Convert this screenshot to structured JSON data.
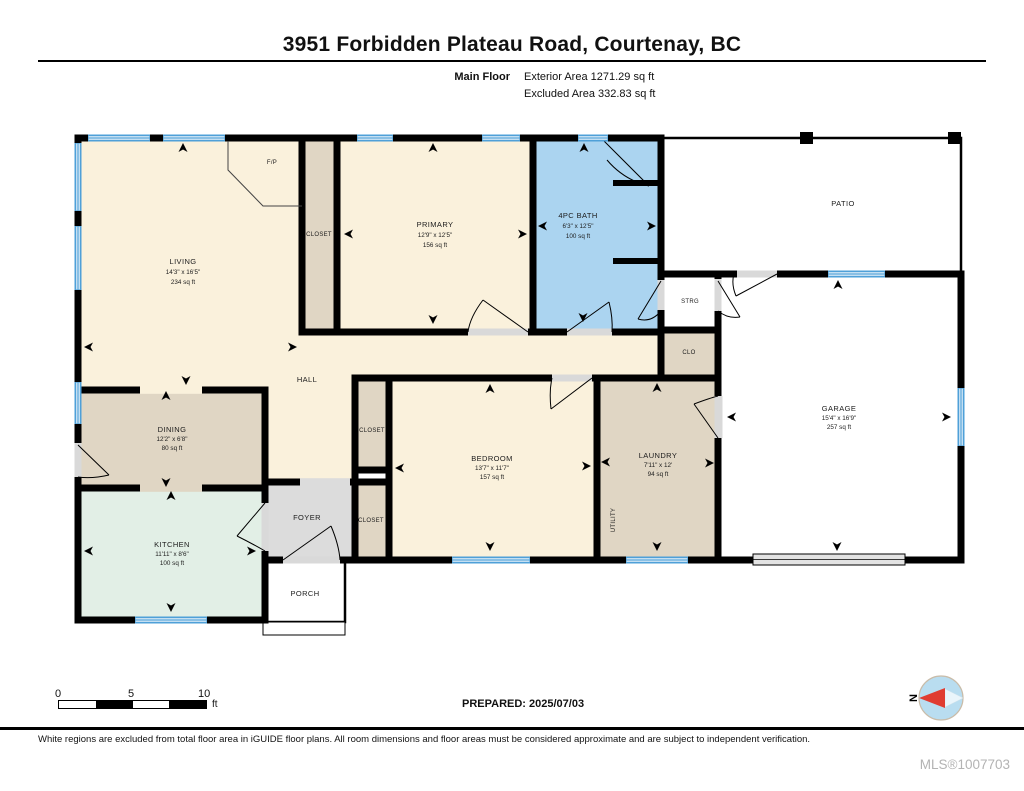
{
  "header": {
    "title": "3951 Forbidden Plateau Road, Courtenay, BC",
    "floor_label": "Main Floor",
    "exterior_area": "Exterior Area 1271.29 sq ft",
    "excluded_area": "Excluded Area 332.83 sq ft"
  },
  "rooms": {
    "living": {
      "name": "LIVING",
      "dims": "14'3\" x 16'5\"",
      "area": "234 sq ft"
    },
    "primary": {
      "name": "PRIMARY",
      "dims": "12'9\" x 12'5\"",
      "area": "156 sq ft"
    },
    "bath": {
      "name": "4PC BATH",
      "dims": "6'3\" x 12'5\"",
      "area": "100 sq ft"
    },
    "dining": {
      "name": "DINING",
      "dims": "12'2\" x 6'8\"",
      "area": "80 sq ft"
    },
    "kitchen": {
      "name": "KITCHEN",
      "dims": "11'11\" x 8'6\"",
      "area": "100 sq ft"
    },
    "bedroom": {
      "name": "BEDROOM",
      "dims": "13'7\" x 11'7\"",
      "area": "157 sq ft"
    },
    "laundry": {
      "name": "LAUNDRY",
      "dims": "7'11\" x 12'",
      "area": "94 sq ft"
    },
    "garage": {
      "name": "GARAGE",
      "dims": "15'4\" x 16'9\"",
      "area": "257 sq ft"
    },
    "patio": {
      "name": "PATIO"
    },
    "porch": {
      "name": "PORCH"
    },
    "foyer": {
      "name": "FOYER"
    },
    "hall": {
      "name": "HALL"
    },
    "utility": {
      "name": "UTILITY"
    },
    "strg": {
      "name": "STRG"
    },
    "clo": {
      "name": "CLO"
    },
    "closet": {
      "name": "CLOSET"
    },
    "fireplace": {
      "name": "F/P"
    }
  },
  "scale_bar": {
    "tick_0": "0",
    "tick_5": "5",
    "tick_10": "10",
    "unit": "ft"
  },
  "prepared": "PREPARED: 2025/07/03",
  "compass": {
    "north_label": "N"
  },
  "footer": {
    "disclaimer": "White regions are excluded from total floor area in iGUIDE floor plans. All room dimensions and floor areas must be considered approximate and are subject to independent verification.",
    "mls": "MLS®1007703"
  },
  "colors": {
    "room_cream": "#FAF1DC",
    "room_tan": "#E0D6C4",
    "room_mint": "#E2EFE6",
    "room_blue": "#ABD4F0",
    "room_gray": "#DCDCDC",
    "excluded_white": "#FFFFFF",
    "window_blue": "#4FA0D8",
    "wall_black": "#000000",
    "compass_red": "#E03C31"
  }
}
